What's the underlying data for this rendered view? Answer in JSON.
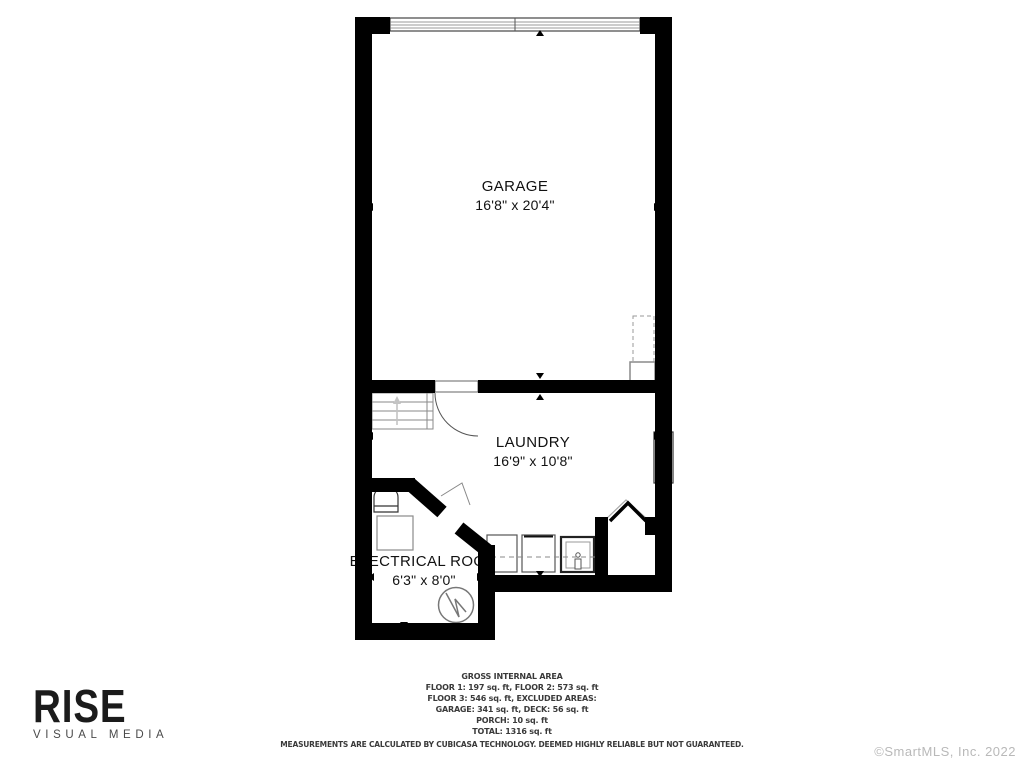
{
  "plan": {
    "rooms": [
      {
        "name": "GARAGE",
        "dims": "16'8\" x 20'4\""
      },
      {
        "name": "LAUNDRY",
        "dims": "16'9\" x 10'8\""
      },
      {
        "name": "ELECTRICAL ROOM",
        "dims": "6'3\" x 8'0\""
      }
    ]
  },
  "footer": {
    "title": "GROSS INTERNAL AREA",
    "lines": [
      "FLOOR 1: 197 sq. ft, FLOOR 2: 573 sq. ft",
      "FLOOR 3: 546 sq. ft, EXCLUDED AREAS:",
      "GARAGE: 341 sq. ft, DECK: 56 sq. ft",
      "PORCH: 10 sq. ft",
      "TOTAL: 1316 sq. ft"
    ],
    "disclaimer": "MEASUREMENTS ARE CALCULATED BY CUBICASA TECHNOLOGY. DEEMED HIGHLY RELIABLE BUT NOT GUARANTEED."
  },
  "branding": {
    "logo": "RISE",
    "tagline": "VISUAL MEDIA"
  },
  "copyright": "©SmartMLS, Inc.  2022",
  "colors": {
    "wall": "#000000",
    "fixture_outline": "#8a8a8a",
    "label_text": "#111111",
    "footer_text": "#3a3a3a",
    "copyright_text": "#b9b9b9"
  }
}
